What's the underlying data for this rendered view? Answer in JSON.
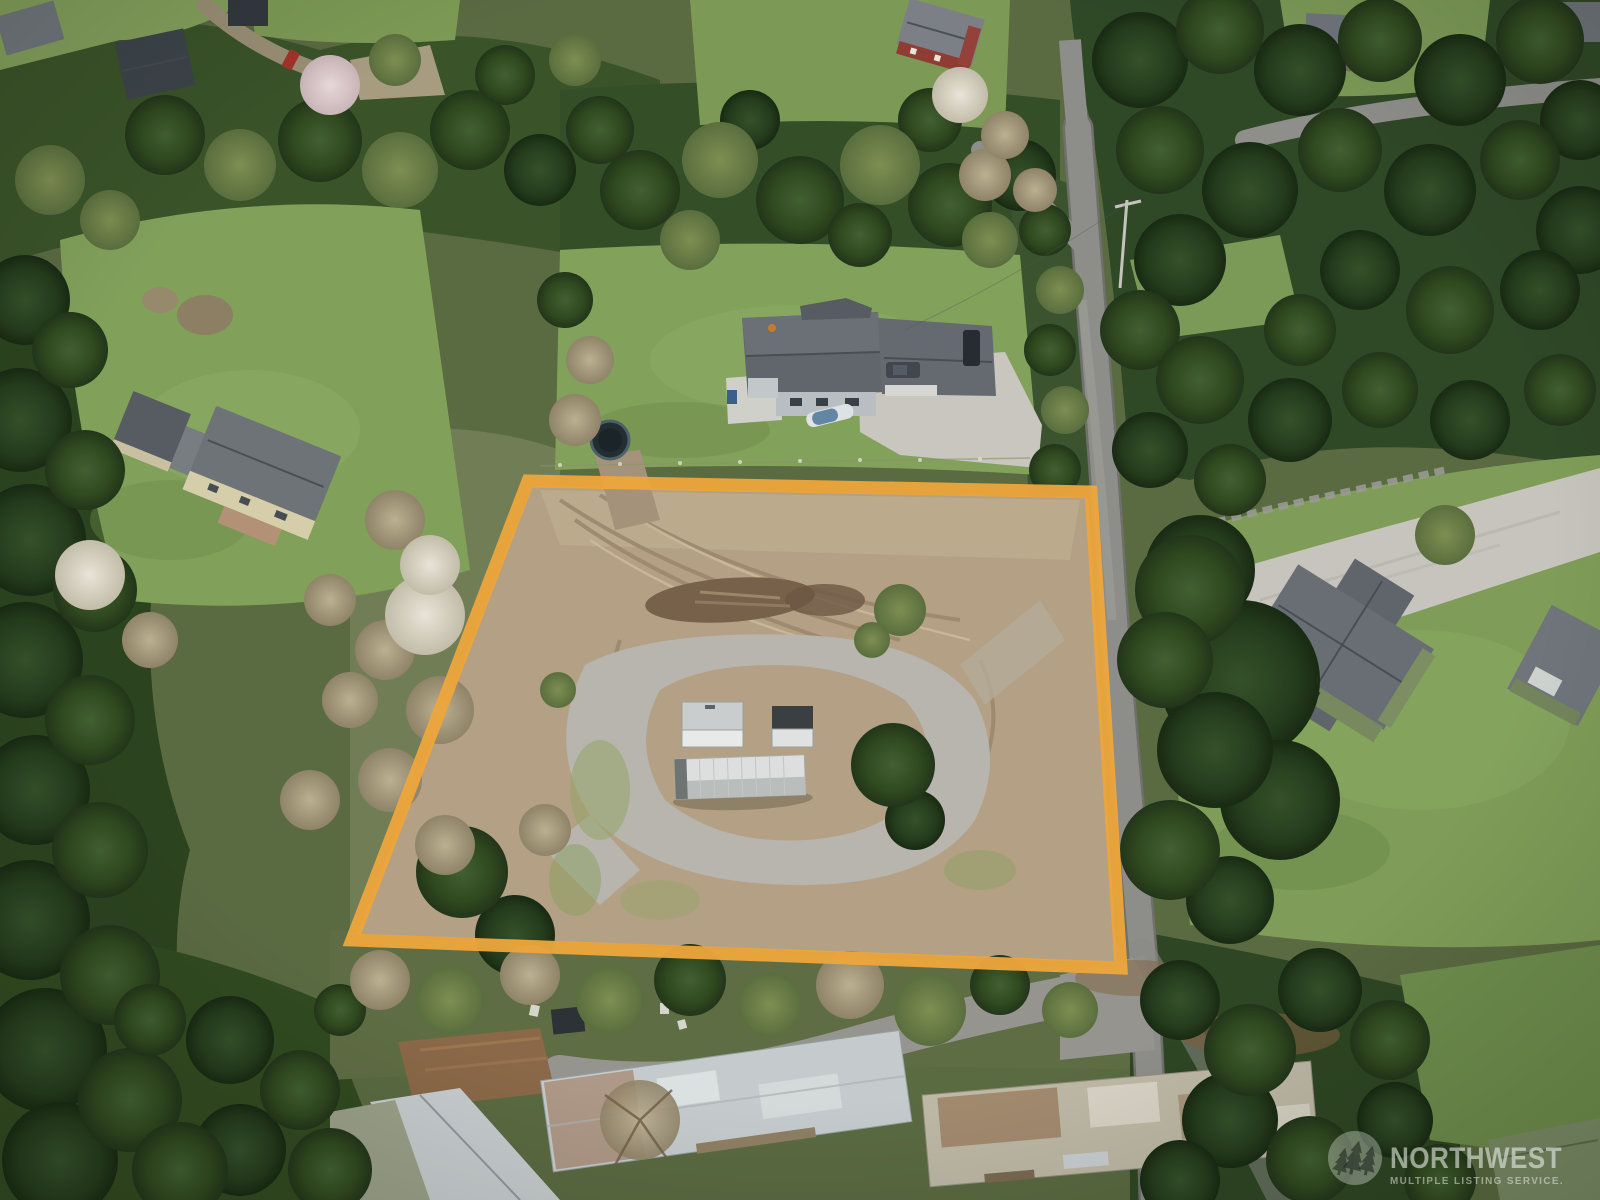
{
  "lot_outline": {
    "color": "#ECA63C",
    "points": "528,481 1091,492 1121,968 352,940",
    "stroke_width": "13"
  },
  "watermark": {
    "brand": "NORTHWEST",
    "tagline": "MULTIPLE LISTING SERVICE.",
    "icon": "three-trees-icon",
    "text_color": "#EEF2EC"
  }
}
